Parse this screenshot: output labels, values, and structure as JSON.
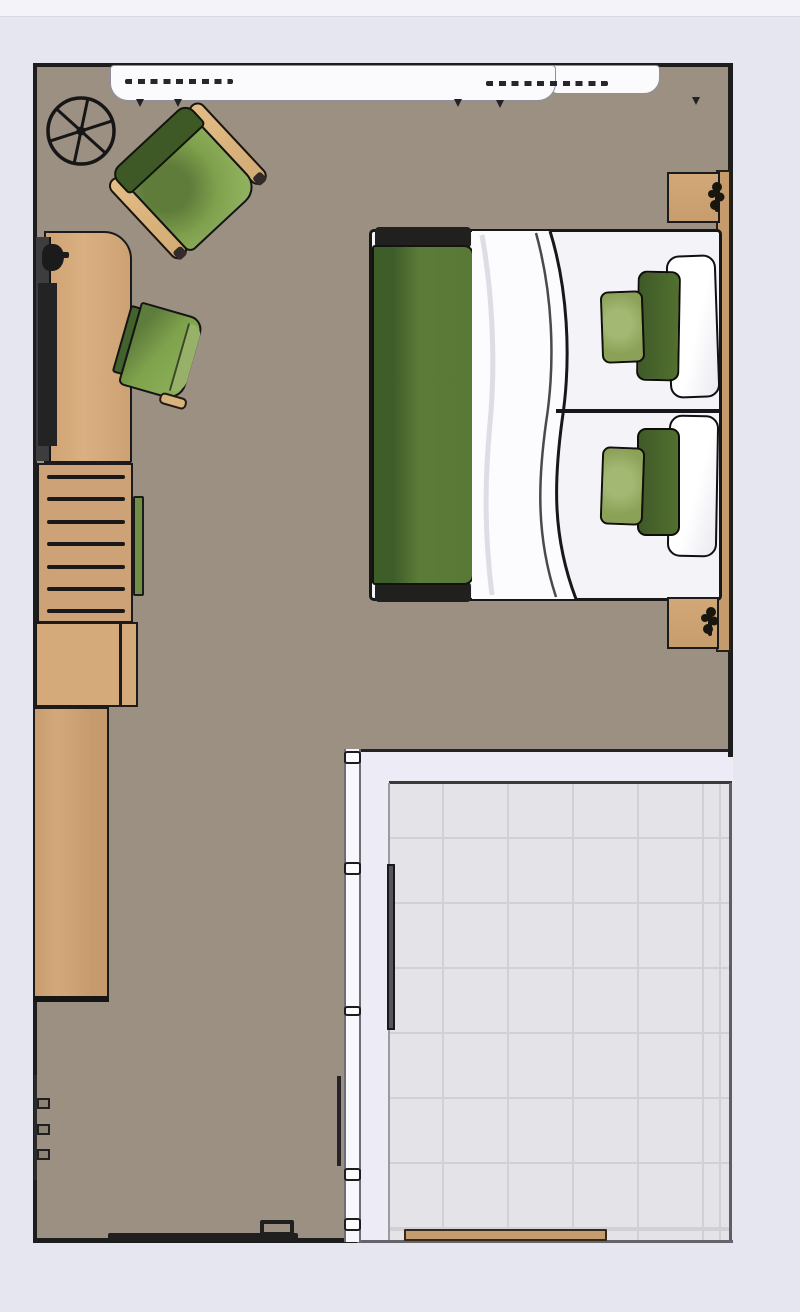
{
  "scene": {
    "type": "floor-plan",
    "view": "top-down",
    "rooms": [
      {
        "id": "bedroom",
        "label": "Bedroom",
        "floor": "carpet",
        "floor_color": "#9c9083"
      },
      {
        "id": "ensuite",
        "label": "En-suite tiled room",
        "floor": "tile",
        "floor_color": "#e4e4e8",
        "tile_line_color": "#d1d1d5"
      }
    ],
    "furniture": [
      {
        "id": "window",
        "label": "Window with curtain rail"
      },
      {
        "id": "ceiling-fan",
        "label": "Ceiling fan"
      },
      {
        "id": "armchair",
        "label": "Green armchair with wooden armrests"
      },
      {
        "id": "desk",
        "label": "Wooden desk"
      },
      {
        "id": "monitor",
        "label": "Monitor on desk"
      },
      {
        "id": "desk-chair",
        "label": "Green desk chair"
      },
      {
        "id": "shelf-unit",
        "label": "Ladder shelf unit"
      },
      {
        "id": "dresser",
        "label": "Wooden dresser"
      },
      {
        "id": "wardrobe",
        "label": "Wooden wardrobe"
      },
      {
        "id": "bed",
        "label": "Double bed with green duvet and pillows"
      },
      {
        "id": "nightstand-top",
        "label": "Nightstand with plant"
      },
      {
        "id": "nightstand-bottom",
        "label": "Nightstand with plant"
      },
      {
        "id": "headboard-panel",
        "label": "Headboard wall panel"
      },
      {
        "id": "wall-hooks",
        "label": "Wall hooks"
      },
      {
        "id": "sliding-door",
        "label": "Sliding door on bottom wall"
      },
      {
        "id": "bathroom-door",
        "label": "Bathroom pocket door"
      },
      {
        "id": "bath-mat",
        "label": "Wooden bath mat"
      }
    ],
    "palette": {
      "background": "#e6e6f0",
      "background_top": "#f3f3f9",
      "wall": "#1d1d1d",
      "carpet": "#9c9083",
      "tile": "#e4e4e8",
      "tile_line": "#d1d1d5",
      "wall_band": "#ecebf6",
      "wood_light": "#dab082",
      "wood_mid": "#cda276",
      "wood_dark": "#c59b6d",
      "green_dark": "#3e5926",
      "green_mid": "#6f8f44",
      "green_seat": "#8fb05c",
      "duvet_green": "#5a7836",
      "pillow_dark_green": "#52702f",
      "pillow_light_green": "#8ba157",
      "linen_white": "#fcfcff"
    }
  }
}
